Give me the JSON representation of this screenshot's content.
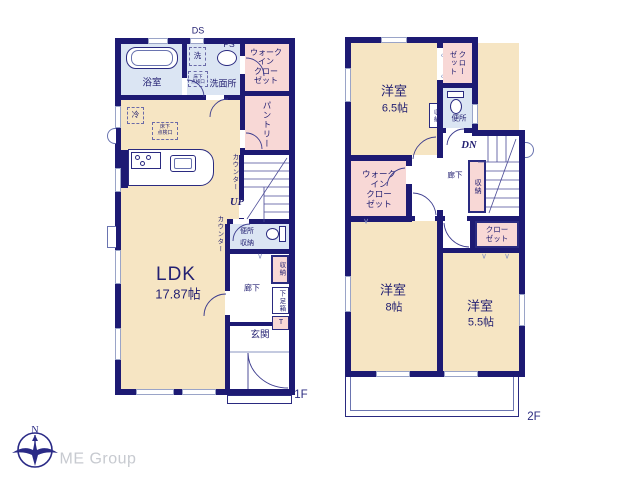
{
  "colors": {
    "wall": "#1d1a73",
    "room_cream": "#f6e5c3",
    "closet_pink": "#f8d8d6",
    "wet_blue": "#dbe5f3",
    "logo_gray": "#c7cad0"
  },
  "logo": {
    "company": "ME Group",
    "north": "N"
  },
  "f1": {
    "tag": "1F",
    "ds": "DS",
    "ps": "PS",
    "bath": "浴室",
    "washer": "洗",
    "sanitary": "洗面所",
    "underfloor_hatch": "床下\n点検口",
    "underfloor_hatch2": "床下\n点検口",
    "fridge": "冷",
    "wic": "ウォーク\nイン\nクロー\nゼット",
    "pantry": "パントリー",
    "counter_a": "カウンター",
    "counter_b": "カウンター",
    "up": "UP",
    "toilet": "便所",
    "toilet_storage": "収納",
    "ldk": "LDK",
    "ldk_size": "17.87帖",
    "hall": "廊下",
    "storage": "収納",
    "shoe_box": "下足箱",
    "shoe_t": "T",
    "entrance": "玄関"
  },
  "f2": {
    "tag": "2F",
    "room_a": "洋室",
    "room_a_size": "6.5帖",
    "closet_top": "クロー\nゼット",
    "toilet": "便所",
    "toilet_storage": "収納",
    "dn": "DN",
    "hall": "廊下",
    "stair_storage": "収納",
    "wic": "ウォーク\nイン\nクロー\nゼット",
    "closet": "クロー\nゼット",
    "room_b": "洋室",
    "room_b_size": "8帖",
    "room_c": "洋室",
    "room_c_size": "5.5帖"
  },
  "icons": {
    "fold_v": "∨",
    "fold_l": "‹"
  }
}
